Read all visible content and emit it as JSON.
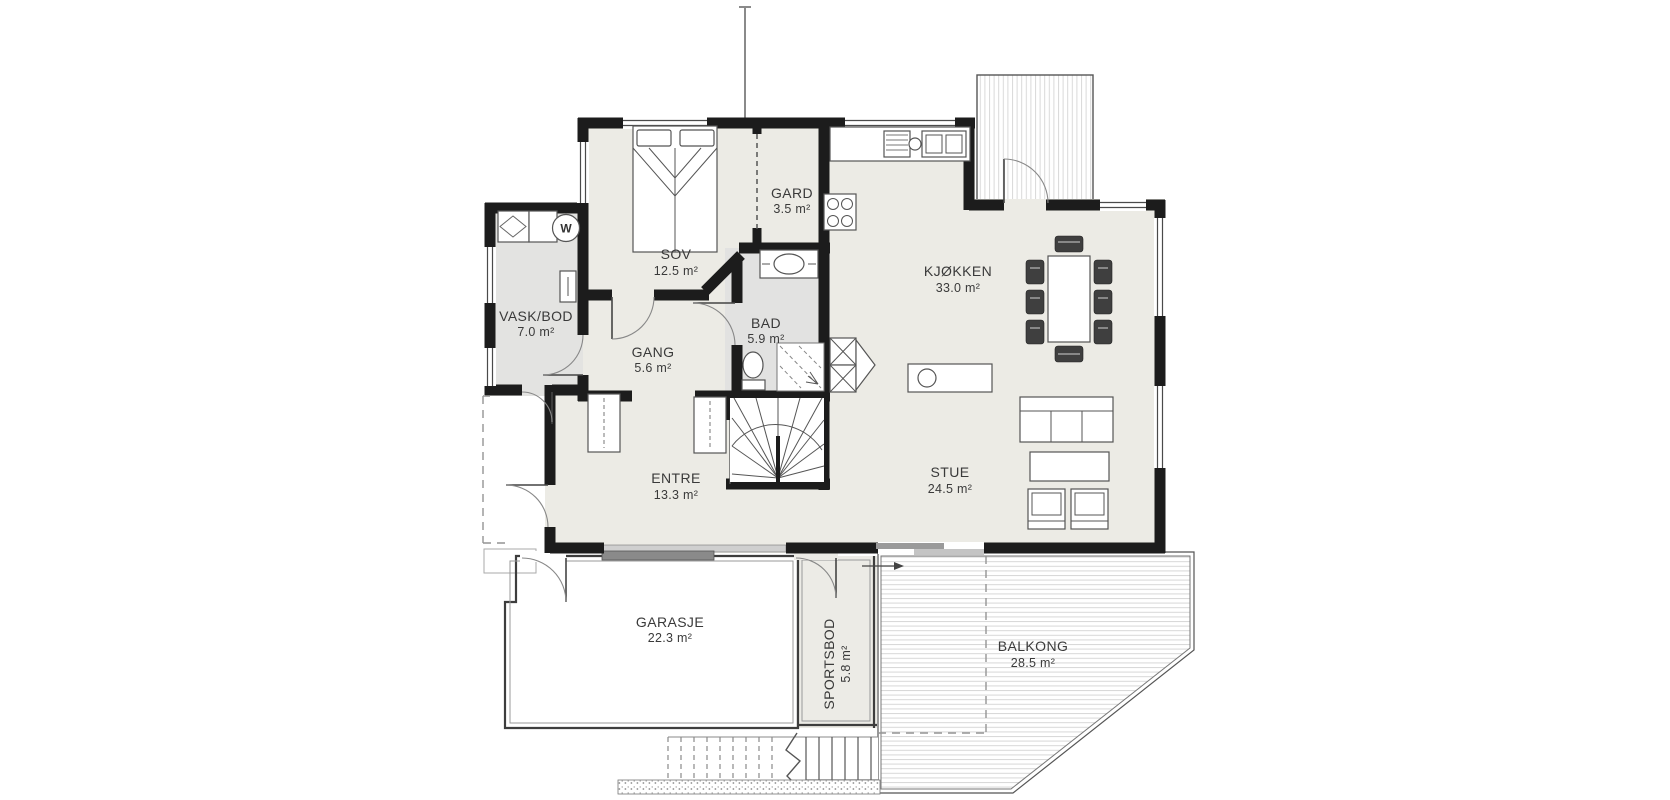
{
  "rooms": [
    {
      "id": "sov",
      "name": "SOV",
      "area": "12.5 m²"
    },
    {
      "id": "gard",
      "name": "GARD",
      "area": "3.5 m²"
    },
    {
      "id": "vask-bod",
      "name": "VASK/BOD",
      "area": "7.0 m²"
    },
    {
      "id": "gang",
      "name": "GANG",
      "area": "5.6 m²"
    },
    {
      "id": "bad",
      "name": "BAD",
      "area": "5.9 m²"
    },
    {
      "id": "kjokken",
      "name": "KJØKKEN",
      "area": "33.0 m²"
    },
    {
      "id": "entre",
      "name": "ENTRE",
      "area": "13.3 m²"
    },
    {
      "id": "stue",
      "name": "STUE",
      "area": "24.5 m²"
    },
    {
      "id": "garasje",
      "name": "GARASJE",
      "area": "22.3 m²"
    },
    {
      "id": "sportsbod",
      "name": "SPORTSBOD",
      "area": "5.8 m²"
    },
    {
      "id": "balkong",
      "name": "BALKONG",
      "area": "28.5 m²"
    }
  ],
  "symbols": {
    "washer_letter": "W"
  },
  "colors": {
    "wall": "#1c1c1c",
    "floor": "#ecebe5",
    "wet_floor": "#e3e3e1",
    "background": "#ffffff",
    "deck_line": "#d7d7d7",
    "garage_door_dark": "#8a8a8a",
    "garage_door_light": "#cfcfcf",
    "label": "#3a3a3a"
  }
}
